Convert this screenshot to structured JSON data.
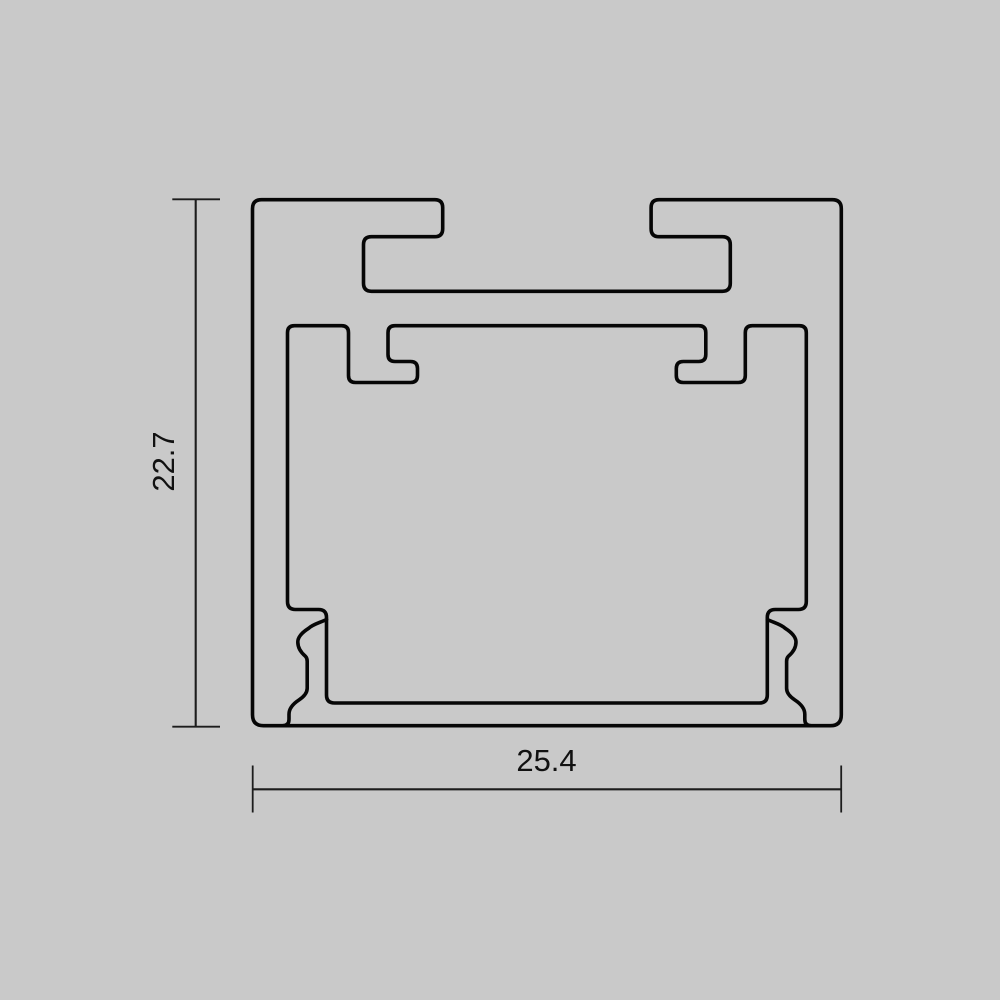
{
  "page": {
    "background_color": "#c9c9c9"
  },
  "drawing": {
    "kind": "profile-cross-section-line-art",
    "outline_color": "#060606",
    "dimension_color": "#1c1c1c",
    "height_dimension": {
      "label": "22.7"
    },
    "width_dimension": {
      "label": "25.4"
    }
  }
}
